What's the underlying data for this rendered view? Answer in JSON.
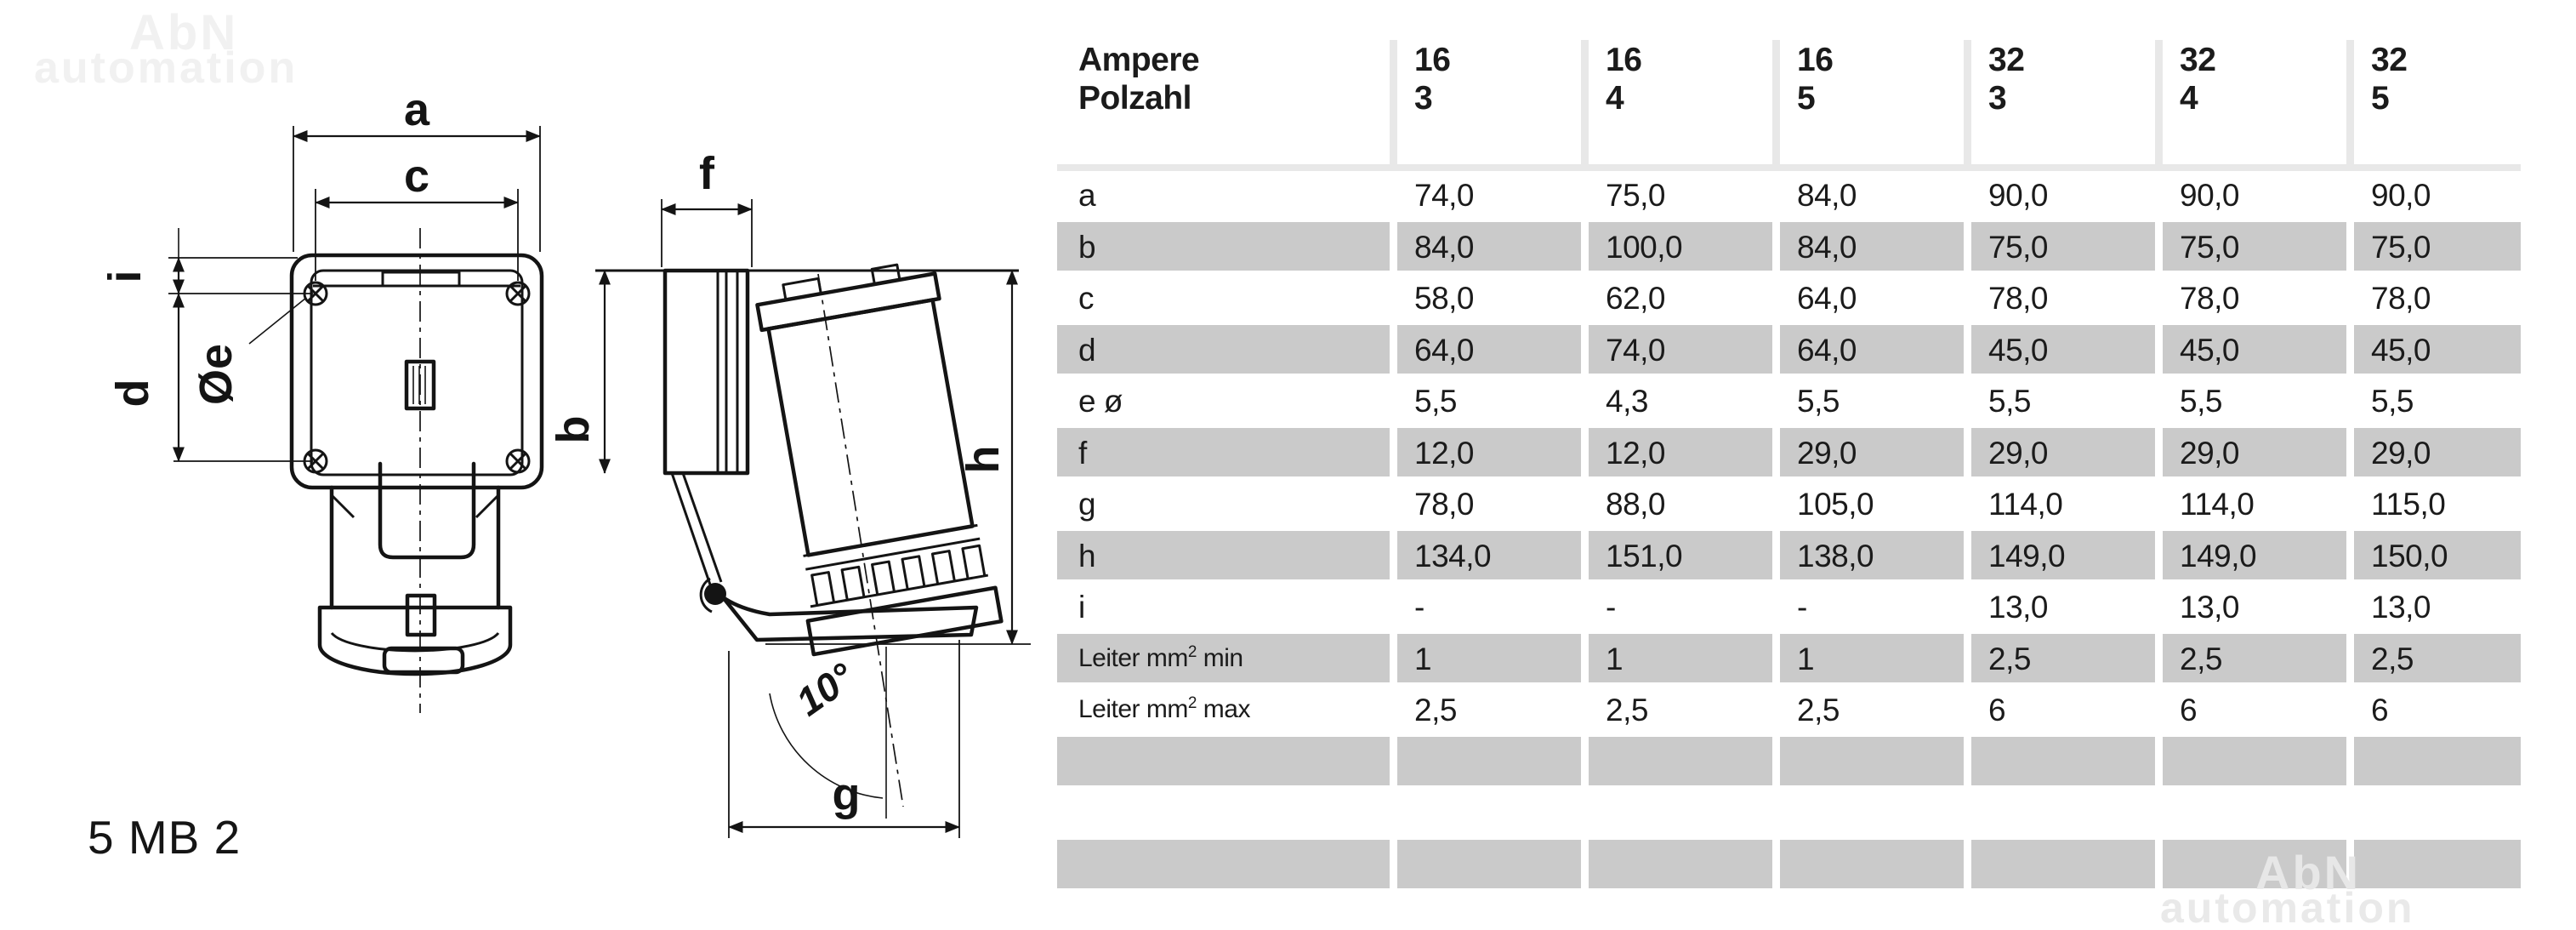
{
  "watermark": {
    "line1": "AbN",
    "line2": "automation"
  },
  "part_number": "5 MB 2",
  "diagram": {
    "front": {
      "dim_a": "a",
      "dim_c": "c",
      "dim_i": "i",
      "dim_d": "d",
      "dim_e": "Øe"
    },
    "side": {
      "dim_f": "f",
      "dim_b": "b",
      "dim_h": "h",
      "dim_g": "g",
      "angle": "10°"
    }
  },
  "table": {
    "header": {
      "row1_label": "Ampere",
      "row2_label": "Polzahl",
      "columns": [
        {
          "ampere": "16",
          "polzahl": "3"
        },
        {
          "ampere": "16",
          "polzahl": "4"
        },
        {
          "ampere": "16",
          "polzahl": "5"
        },
        {
          "ampere": "32",
          "polzahl": "3"
        },
        {
          "ampere": "32",
          "polzahl": "4"
        },
        {
          "ampere": "32",
          "polzahl": "5"
        }
      ]
    },
    "rows": [
      {
        "label": "a",
        "shaded": false,
        "values": [
          "74,0",
          "75,0",
          "84,0",
          "90,0",
          "90,0",
          "90,0"
        ]
      },
      {
        "label": "b",
        "shaded": true,
        "values": [
          "84,0",
          "100,0",
          "84,0",
          "75,0",
          "75,0",
          "75,0"
        ]
      },
      {
        "label": "c",
        "shaded": false,
        "values": [
          "58,0",
          "62,0",
          "64,0",
          "78,0",
          "78,0",
          "78,0"
        ]
      },
      {
        "label": "d",
        "shaded": true,
        "values": [
          "64,0",
          "74,0",
          "64,0",
          "45,0",
          "45,0",
          "45,0"
        ]
      },
      {
        "label": "e ø",
        "shaded": false,
        "values": [
          "5,5",
          "4,3",
          "5,5",
          "5,5",
          "5,5",
          "5,5"
        ]
      },
      {
        "label": "f",
        "shaded": true,
        "values": [
          "12,0",
          "12,0",
          "29,0",
          "29,0",
          "29,0",
          "29,0"
        ]
      },
      {
        "label": "g",
        "shaded": false,
        "values": [
          "78,0",
          "88,0",
          "105,0",
          "114,0",
          "114,0",
          "115,0"
        ]
      },
      {
        "label": "h",
        "shaded": true,
        "values": [
          "134,0",
          "151,0",
          "138,0",
          "149,0",
          "149,0",
          "150,0"
        ]
      },
      {
        "label": "i",
        "shaded": false,
        "values": [
          "-",
          "-",
          "-",
          "13,0",
          "13,0",
          "13,0"
        ]
      },
      {
        "label_prefix": "Leiter mm",
        "label_sup": "2",
        "label_suffix": " min",
        "shaded": true,
        "values": [
          "1",
          "1",
          "1",
          "2,5",
          "2,5",
          "2,5"
        ]
      },
      {
        "label_prefix": "Leiter mm",
        "label_sup": "2",
        "label_suffix": " max",
        "shaded": false,
        "values": [
          "2,5",
          "2,5",
          "2,5",
          "6",
          "6",
          "6"
        ]
      },
      {
        "label": "",
        "shaded": true,
        "values": [
          "",
          "",
          "",
          "",
          "",
          ""
        ]
      },
      {
        "label": "",
        "shaded": false,
        "values": [
          "",
          "",
          "",
          "",
          "",
          ""
        ]
      },
      {
        "label": "",
        "shaded": true,
        "values": [
          "",
          "",
          "",
          "",
          "",
          ""
        ]
      }
    ]
  },
  "colors": {
    "row_shaded": "#cacaca",
    "header_separator": "#e8e8e8",
    "text": "#1b1b1b",
    "watermark": "#ededed"
  }
}
